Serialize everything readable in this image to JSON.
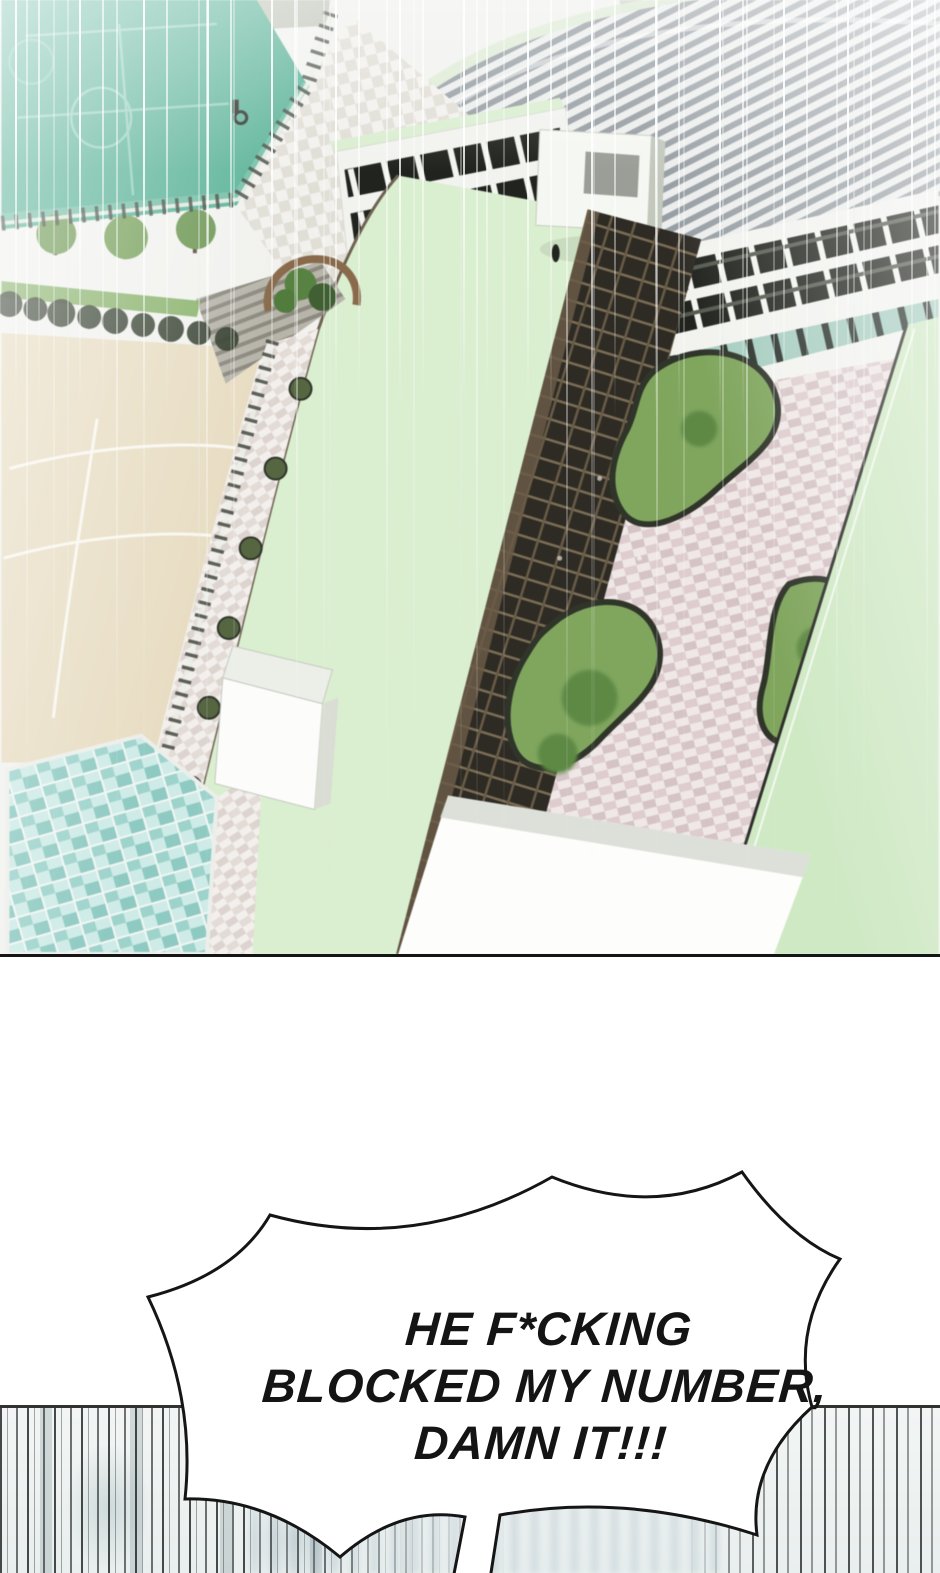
{
  "speech_bubble": {
    "line1": "HE F*CKING",
    "line2": "BLOCKED MY NUMBER,",
    "line3": "DAMN IT!!!"
  },
  "palette": {
    "panel_border": "#151515",
    "court_green": "#55b397",
    "court_line": "#8ed0ba",
    "sand_field": "#e9ddc2",
    "mint_roof": "#d9eecf",
    "mint_roof_alt": "#cfe9c4",
    "garden_green": "#7fa75b",
    "pavement_pink": "#dfcccf",
    "glass_teal": "#9bd4cb",
    "roof_stripe": "#979ea3",
    "facade_white": "#f2f3ef",
    "facade_shadow": "#2e2b25",
    "speedline_dark": "#262b2b",
    "bubble_fill": "#ffffff",
    "bubble_outline": "#151515"
  }
}
